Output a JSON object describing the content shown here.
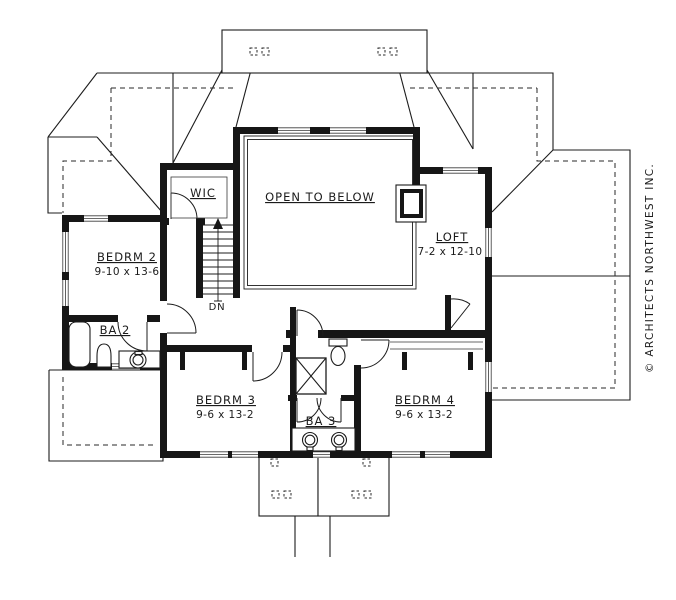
{
  "plan": {
    "rooms": [
      {
        "id": "open-to-below",
        "name": "OPEN TO BELOW",
        "dims": ""
      },
      {
        "id": "wic",
        "name": "WIC",
        "dims": ""
      },
      {
        "id": "bedrm2",
        "name": "BEDRM 2",
        "dims": "9-10 x 13-6"
      },
      {
        "id": "loft",
        "name": "LOFT",
        "dims": "7-2 x 12-10"
      },
      {
        "id": "ba2",
        "name": "BA 2",
        "dims": ""
      },
      {
        "id": "bedrm3",
        "name": "BEDRM 3",
        "dims": "9-6 x 13-2"
      },
      {
        "id": "bedrm4",
        "name": "BEDRM 4",
        "dims": "9-6 x 13-2"
      },
      {
        "id": "ba3",
        "name": "BA 3",
        "dims": ""
      }
    ],
    "stair_label": "DN",
    "copyright": "© ARCHITECTS NORTHWEST INC."
  },
  "colors": {
    "ink": "#1b1b1b",
    "background": "#ffffff"
  }
}
